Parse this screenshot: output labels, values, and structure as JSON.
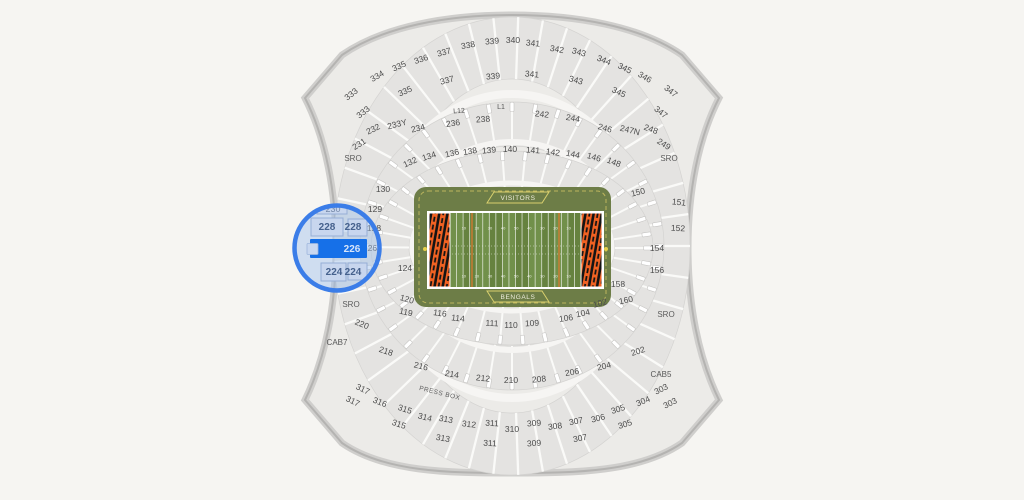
{
  "stadium": {
    "palette": {
      "background": "#f6f5f2",
      "bowl_fill": "#ecebe8",
      "band_fill": "#e4e3e1",
      "outline": "#b4b3b1",
      "divider_white": "#fafaf8",
      "walkway_white": "#f6f5f3",
      "label_text": "#4c4c4c",
      "apron_olive": "#6d7d47",
      "field_green": "#66823f",
      "field_green_light": "#71904a",
      "endzone_orange": "#f26222",
      "endzone_stripe": "#141414",
      "banner_yellow": "#d9d06d",
      "accent_blue": "#3b7de8",
      "selected_blue": "#1670e8",
      "magnifier_wash": "#9fc0ee"
    },
    "sections": [
      {
        "t": "333",
        "x": 351,
        "y": 94,
        "r": -38
      },
      {
        "t": "333",
        "x": 363,
        "y": 112,
        "r": -38
      },
      {
        "t": "334",
        "x": 377,
        "y": 76,
        "r": -30
      },
      {
        "t": "335",
        "x": 399,
        "y": 66,
        "r": -24
      },
      {
        "t": "335",
        "x": 405,
        "y": 91,
        "r": -24
      },
      {
        "t": "336",
        "x": 421,
        "y": 59,
        "r": -19
      },
      {
        "t": "337",
        "x": 444,
        "y": 52,
        "r": -15
      },
      {
        "t": "337",
        "x": 447,
        "y": 80,
        "r": -15
      },
      {
        "t": "338",
        "x": 468,
        "y": 45,
        "r": -10
      },
      {
        "t": "339",
        "x": 492,
        "y": 41,
        "r": -5
      },
      {
        "t": "339",
        "x": 493,
        "y": 76,
        "r": -5
      },
      {
        "t": "340",
        "x": 513,
        "y": 40,
        "r": 0
      },
      {
        "t": "341",
        "x": 533,
        "y": 43,
        "r": 5
      },
      {
        "t": "341",
        "x": 532,
        "y": 74,
        "r": 5
      },
      {
        "t": "342",
        "x": 557,
        "y": 49,
        "r": 10
      },
      {
        "t": "343",
        "x": 579,
        "y": 52,
        "r": 15
      },
      {
        "t": "343",
        "x": 576,
        "y": 80,
        "r": 15
      },
      {
        "t": "344",
        "x": 604,
        "y": 60,
        "r": 22
      },
      {
        "t": "345",
        "x": 625,
        "y": 68,
        "r": 26
      },
      {
        "t": "345",
        "x": 619,
        "y": 92,
        "r": 25
      },
      {
        "t": "346",
        "x": 645,
        "y": 77,
        "r": 30
      },
      {
        "t": "347",
        "x": 671,
        "y": 91,
        "r": 38
      },
      {
        "t": "347",
        "x": 661,
        "y": 112,
        "r": 38
      },
      {
        "t": "231",
        "x": 359,
        "y": 144,
        "r": -32
      },
      {
        "t": "232",
        "x": 373,
        "y": 129,
        "r": -26
      },
      {
        "t": "233Y",
        "x": 397,
        "y": 124,
        "r": -14
      },
      {
        "t": "234",
        "x": 418,
        "y": 128,
        "r": -14
      },
      {
        "t": "236",
        "x": 453,
        "y": 123,
        "r": -8
      },
      {
        "t": "L12",
        "x": 459,
        "y": 110,
        "r": -4,
        "k": "small"
      },
      {
        "t": "L1",
        "x": 501,
        "y": 106,
        "r": 0,
        "k": "small"
      },
      {
        "t": "238",
        "x": 483,
        "y": 119,
        "r": -4
      },
      {
        "t": "242",
        "x": 542,
        "y": 114,
        "r": 6
      },
      {
        "t": "244",
        "x": 573,
        "y": 118,
        "r": 10
      },
      {
        "t": "246",
        "x": 605,
        "y": 128,
        "r": 16
      },
      {
        "t": "247N",
        "x": 630,
        "y": 130,
        "r": 14
      },
      {
        "t": "248",
        "x": 651,
        "y": 129,
        "r": 20
      },
      {
        "t": "249",
        "x": 664,
        "y": 144,
        "r": 32
      },
      {
        "t": "SRO",
        "x": 353,
        "y": 158,
        "r": 0,
        "k": "sro"
      },
      {
        "t": "SRO",
        "x": 669,
        "y": 158,
        "r": 0,
        "k": "sro"
      },
      {
        "t": "132",
        "x": 410,
        "y": 162,
        "r": -24
      },
      {
        "t": "134",
        "x": 429,
        "y": 156,
        "r": -18
      },
      {
        "t": "136",
        "x": 452,
        "y": 153,
        "r": -13
      },
      {
        "t": "138",
        "x": 470,
        "y": 151,
        "r": -9
      },
      {
        "t": "139",
        "x": 489,
        "y": 150,
        "r": -5
      },
      {
        "t": "140",
        "x": 510,
        "y": 149,
        "r": 0
      },
      {
        "t": "141",
        "x": 533,
        "y": 150,
        "r": 4
      },
      {
        "t": "142",
        "x": 553,
        "y": 152,
        "r": 8
      },
      {
        "t": "144",
        "x": 573,
        "y": 154,
        "r": 12
      },
      {
        "t": "146",
        "x": 594,
        "y": 157,
        "r": 16
      },
      {
        "t": "148",
        "x": 614,
        "y": 162,
        "r": 21
      },
      {
        "t": "130",
        "x": 383,
        "y": 189,
        "r": 0
      },
      {
        "t": "129",
        "x": 375,
        "y": 209,
        "r": 0
      },
      {
        "t": "128",
        "x": 374,
        "y": 228,
        "r": 0
      },
      {
        "t": "126",
        "x": 370,
        "y": 248,
        "r": 0
      },
      {
        "t": "124",
        "x": 405,
        "y": 268,
        "r": 0
      },
      {
        "t": "150",
        "x": 638,
        "y": 192,
        "r": -14
      },
      {
        "t": "151",
        "x": 679,
        "y": 202,
        "r": 6
      },
      {
        "t": "152",
        "x": 678,
        "y": 228,
        "r": 3
      },
      {
        "t": "154",
        "x": 657,
        "y": 248,
        "r": 0
      },
      {
        "t": "156",
        "x": 657,
        "y": 270,
        "r": 0
      },
      {
        "t": "158",
        "x": 618,
        "y": 284,
        "r": 0
      },
      {
        "t": "160",
        "x": 626,
        "y": 300,
        "r": -12
      },
      {
        "t": "102",
        "x": 600,
        "y": 303,
        "r": -16
      },
      {
        "t": "104",
        "x": 583,
        "y": 313,
        "r": -12
      },
      {
        "t": "106",
        "x": 566,
        "y": 318,
        "r": -8
      },
      {
        "t": "109",
        "x": 532,
        "y": 323,
        "r": -3
      },
      {
        "t": "110",
        "x": 511,
        "y": 325,
        "r": 0
      },
      {
        "t": "111",
        "x": 492,
        "y": 323,
        "r": 3
      },
      {
        "t": "114",
        "x": 458,
        "y": 318,
        "r": 6
      },
      {
        "t": "116",
        "x": 440,
        "y": 313,
        "r": 8
      },
      {
        "t": "119",
        "x": 406,
        "y": 312,
        "r": 12
      },
      {
        "t": "120",
        "x": 407,
        "y": 299,
        "r": 16
      },
      {
        "t": "SRO",
        "x": 351,
        "y": 304,
        "r": 0,
        "k": "sro"
      },
      {
        "t": "SRO",
        "x": 666,
        "y": 314,
        "r": 0,
        "k": "sro"
      },
      {
        "t": "220",
        "x": 362,
        "y": 324,
        "r": 22
      },
      {
        "t": "CAB7",
        "x": 337,
        "y": 342,
        "r": 0,
        "k": "cab"
      },
      {
        "t": "218",
        "x": 386,
        "y": 351,
        "r": 18
      },
      {
        "t": "216",
        "x": 421,
        "y": 366,
        "r": 14
      },
      {
        "t": "214",
        "x": 452,
        "y": 374,
        "r": 10
      },
      {
        "t": "212",
        "x": 483,
        "y": 378,
        "r": 6
      },
      {
        "t": "210",
        "x": 511,
        "y": 380,
        "r": 0
      },
      {
        "t": "208",
        "x": 539,
        "y": 379,
        "r": -5
      },
      {
        "t": "206",
        "x": 572,
        "y": 372,
        "r": -10
      },
      {
        "t": "204",
        "x": 604,
        "y": 366,
        "r": -14
      },
      {
        "t": "202",
        "x": 638,
        "y": 351,
        "r": -18
      },
      {
        "t": "CAB5",
        "x": 661,
        "y": 374,
        "r": 0,
        "k": "cab"
      },
      {
        "t": "PRESS BOX",
        "x": 440,
        "y": 392,
        "r": 14,
        "k": "pb"
      },
      {
        "t": "317",
        "x": 363,
        "y": 389,
        "r": 26
      },
      {
        "t": "317",
        "x": 353,
        "y": 401,
        "r": 26
      },
      {
        "t": "316",
        "x": 380,
        "y": 402,
        "r": 22
      },
      {
        "t": "315",
        "x": 405,
        "y": 409,
        "r": 18
      },
      {
        "t": "315",
        "x": 399,
        "y": 424,
        "r": 18
      },
      {
        "t": "314",
        "x": 425,
        "y": 417,
        "r": 14
      },
      {
        "t": "313",
        "x": 446,
        "y": 419,
        "r": 10
      },
      {
        "t": "313",
        "x": 443,
        "y": 438,
        "r": 10
      },
      {
        "t": "312",
        "x": 469,
        "y": 424,
        "r": 7
      },
      {
        "t": "311",
        "x": 492,
        "y": 423,
        "r": 3
      },
      {
        "t": "311",
        "x": 490,
        "y": 443,
        "r": 3
      },
      {
        "t": "310",
        "x": 512,
        "y": 429,
        "r": 0
      },
      {
        "t": "309",
        "x": 534,
        "y": 423,
        "r": -4
      },
      {
        "t": "309",
        "x": 534,
        "y": 443,
        "r": -4
      },
      {
        "t": "308",
        "x": 555,
        "y": 426,
        "r": -7
      },
      {
        "t": "307",
        "x": 576,
        "y": 421,
        "r": -11
      },
      {
        "t": "307",
        "x": 580,
        "y": 438,
        "r": -11
      },
      {
        "t": "306",
        "x": 598,
        "y": 418,
        "r": -14
      },
      {
        "t": "305",
        "x": 618,
        "y": 409,
        "r": -18
      },
      {
        "t": "305",
        "x": 625,
        "y": 424,
        "r": -18
      },
      {
        "t": "304",
        "x": 643,
        "y": 401,
        "r": -22
      },
      {
        "t": "303",
        "x": 661,
        "y": 389,
        "r": -26
      },
      {
        "t": "303",
        "x": 670,
        "y": 403,
        "r": -26
      }
    ]
  },
  "field": {
    "visitors_label": "VISITORS",
    "bengals_label": "BENGALS",
    "yard_numbers": [
      "10",
      "20",
      "30",
      "40",
      "50",
      "40",
      "30",
      "20",
      "10"
    ]
  },
  "magnifier": {
    "highlighted_section": "226",
    "labels": [
      {
        "t": "230",
        "x": 333,
        "y": 209,
        "k": "magdim"
      },
      {
        "t": "228",
        "x": 327,
        "y": 227,
        "k": "mag"
      },
      {
        "t": "228",
        "x": 353,
        "y": 227,
        "k": "mag"
      },
      {
        "t": "226",
        "x": 352,
        "y": 249,
        "k": "hl"
      },
      {
        "t": "224",
        "x": 334,
        "y": 272,
        "k": "mag"
      },
      {
        "t": "224",
        "x": 353,
        "y": 272,
        "k": "mag"
      }
    ]
  }
}
